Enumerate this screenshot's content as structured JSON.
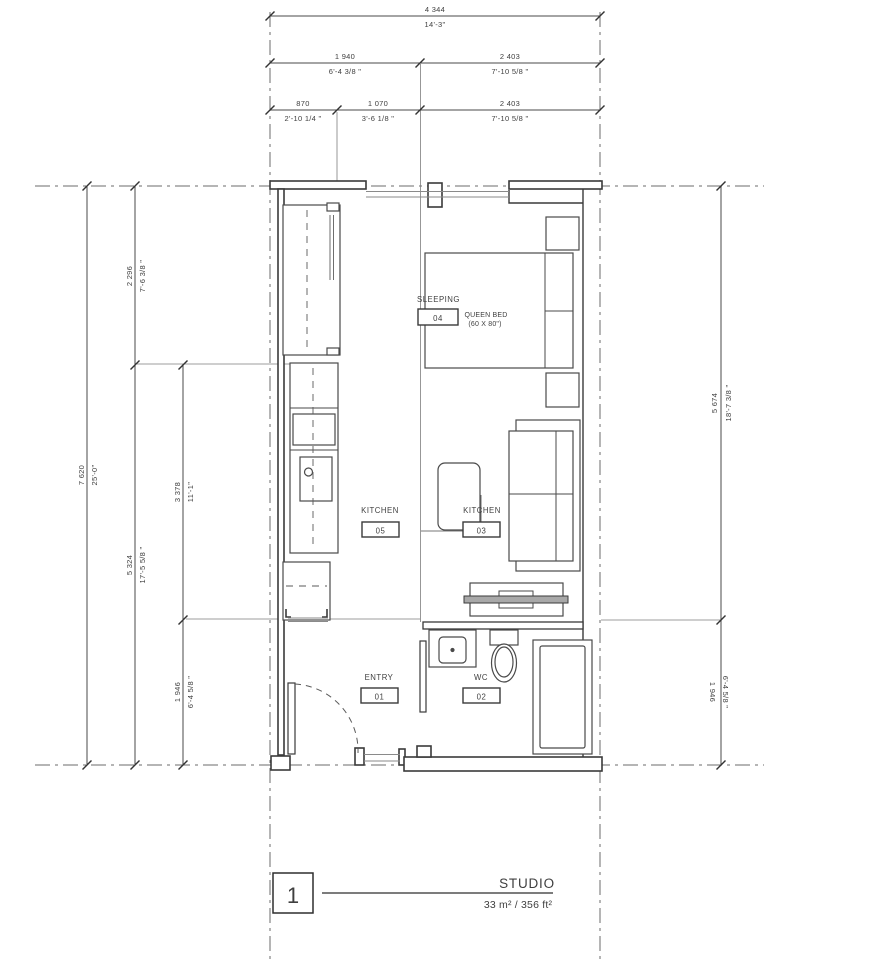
{
  "title_block": {
    "number": "1",
    "name": "STUDIO",
    "area": "33 m² / 356 ft²"
  },
  "rooms": {
    "sleeping": {
      "label": "SLEEPING",
      "tag": "04",
      "note1": "QUEEN BED",
      "note2": "(60 X 80\")"
    },
    "kitchen": {
      "label": "KITCHEN",
      "tag": "05"
    },
    "living": {
      "label": "KITCHEN",
      "tag": "03"
    },
    "entry": {
      "label": "ENTRY",
      "tag": "01"
    },
    "wc": {
      "label": "WC",
      "tag": "02"
    }
  },
  "dimensions": {
    "top": [
      {
        "mm": "4 344",
        "ft": "14'-3\""
      },
      {
        "mm": "1 940",
        "ft": "6'-4 3/8 \""
      },
      {
        "mm": "2 403",
        "ft": "7'-10 5/8 \""
      },
      {
        "mm": "870",
        "ft": "2'-10 1/4 \""
      },
      {
        "mm": "1 070",
        "ft": "3'-6 1/8 \""
      },
      {
        "mm": "2 403",
        "ft": "7'-10 5/8 \""
      }
    ],
    "left": [
      {
        "mm": "7 620",
        "ft": "25'-0\""
      },
      {
        "mm": "2 296",
        "ft": "7'-6 3/8 \""
      },
      {
        "mm": "5 324",
        "ft": "17'-5 5/8 \""
      },
      {
        "mm": "3 378",
        "ft": "11'-1\""
      },
      {
        "mm": "1 946",
        "ft": "6'-4 5/8 \""
      }
    ],
    "right": [
      {
        "mm": "5 674",
        "ft": "18'-7 3/8 \""
      },
      {
        "mm": "1 946",
        "ft": "6'-4 5/8 \""
      }
    ]
  },
  "colors": {
    "line_dark": "#3a3a3a",
    "line_mid": "#4a4a4a",
    "line_gray": "#909090",
    "text": "#3f3f3f"
  }
}
